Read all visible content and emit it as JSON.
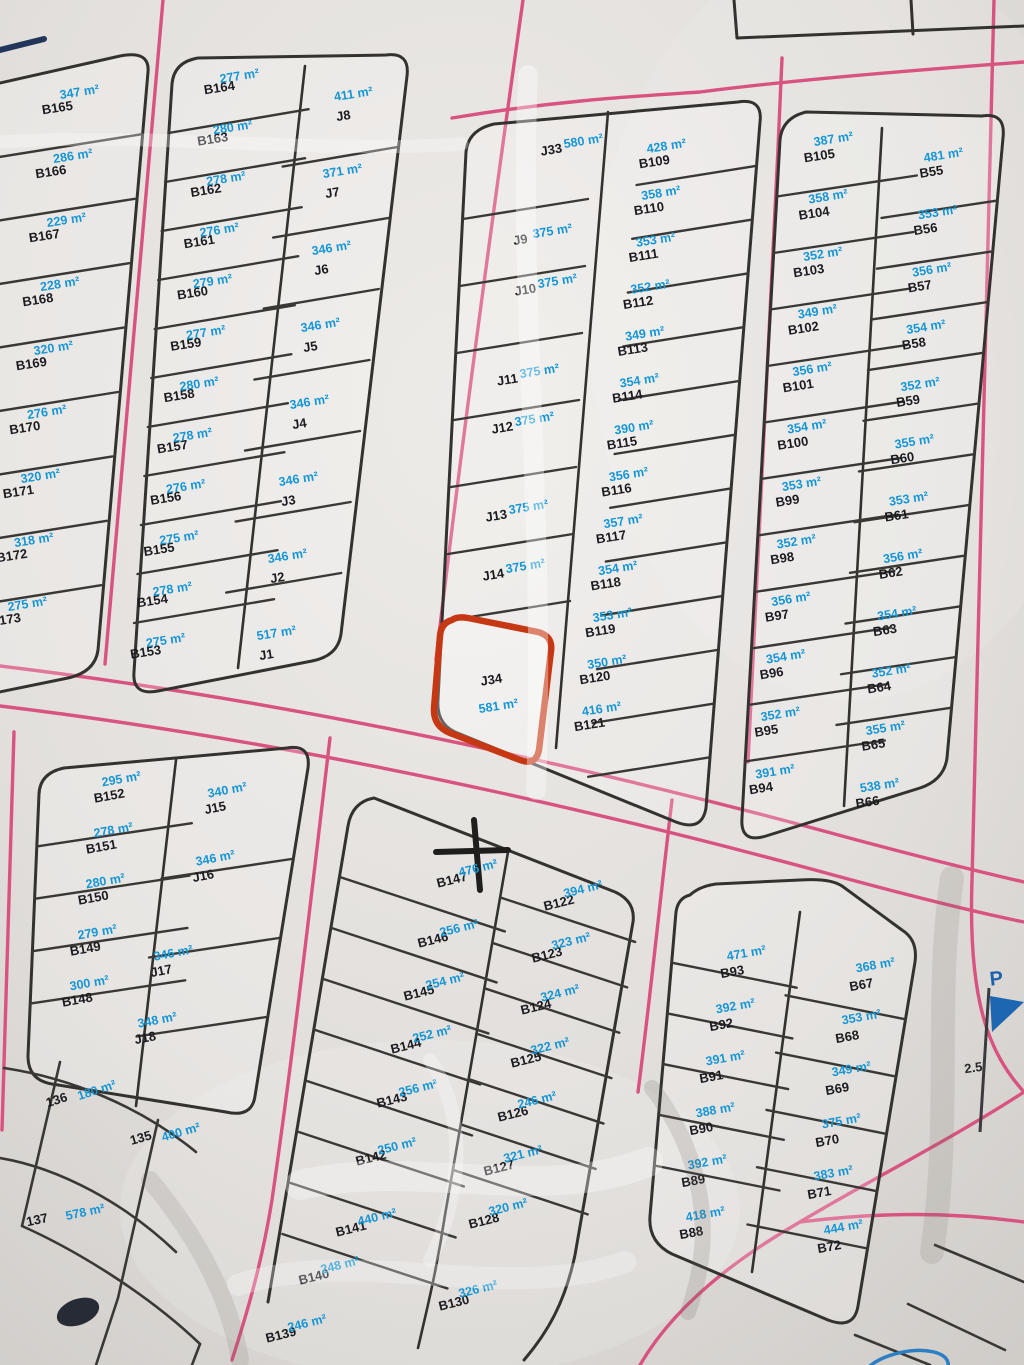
{
  "palette": {
    "road": "#d8537f",
    "parcel_line": "#34322e",
    "id_text": "#1b1b20",
    "area_text": "#1596d4",
    "highlight": "#c63813",
    "paper": "#e2dfdc"
  },
  "blocks": {
    "nw": {
      "rows": [
        {
          "id": "B165",
          "area": "347 m²"
        },
        {
          "id": "B166",
          "area": "286 m²"
        },
        {
          "id": "B167",
          "area": "229 m²"
        },
        {
          "id": "B168",
          "area": "228 m²"
        },
        {
          "id": "B169",
          "area": "320 m²"
        },
        {
          "id": "B170",
          "area": "276 m²"
        },
        {
          "id": "B171",
          "area": "320 m²"
        },
        {
          "id": "B172",
          "area": "318 m²"
        },
        {
          "id": "B173",
          "area": "275 m²"
        }
      ]
    },
    "west": {
      "left": [
        {
          "id": "B164",
          "area": "277 m²"
        },
        {
          "id": "B163",
          "area": "280 m²"
        },
        {
          "id": "B162",
          "area": "278 m²"
        },
        {
          "id": "B161",
          "area": "276 m²"
        },
        {
          "id": "B160",
          "area": "279 m²"
        },
        {
          "id": "B159",
          "area": "277 m²"
        },
        {
          "id": "B158",
          "area": "280 m²"
        },
        {
          "id": "B157",
          "area": "278 m²"
        },
        {
          "id": "B156",
          "area": "276 m²"
        },
        {
          "id": "B155",
          "area": "275 m²"
        },
        {
          "id": "B154",
          "area": "278 m²"
        },
        {
          "id": "B153",
          "area": "275 m²"
        }
      ],
      "right": [
        {
          "id": "J8",
          "area": "411 m²"
        },
        {
          "id": "J7",
          "area": "371 m²"
        },
        {
          "id": "J6",
          "area": "346 m²"
        },
        {
          "id": "J5",
          "area": "346 m²"
        },
        {
          "id": "J4",
          "area": "346 m²"
        },
        {
          "id": "J3",
          "area": "346 m²"
        },
        {
          "id": "J2",
          "area": "346 m²"
        },
        {
          "id": "J1",
          "area": "517 m²"
        }
      ]
    },
    "central": {
      "left": [
        {
          "id": "J33",
          "area": "580 m²"
        },
        {
          "id": "J9",
          "area": "375 m²"
        },
        {
          "id": "J10",
          "area": "375 m²"
        },
        {
          "id": "J11",
          "area": "375 m²"
        },
        {
          "id": "J12",
          "area": "375 m²"
        },
        {
          "id": "J13",
          "area": "375 m²"
        },
        {
          "id": "J14",
          "area": "375 m²"
        }
      ],
      "right": [
        {
          "id": "B109",
          "area": "428 m²"
        },
        {
          "id": "B110",
          "area": "358 m²"
        },
        {
          "id": "B111",
          "area": "353 m²"
        },
        {
          "id": "B112",
          "area": "352 m²"
        },
        {
          "id": "B113",
          "area": "349 m²"
        },
        {
          "id": "B114",
          "area": "354 m²"
        },
        {
          "id": "B115",
          "area": "390 m²"
        },
        {
          "id": "B116",
          "area": "356 m²"
        },
        {
          "id": "B117",
          "area": "357 m²"
        },
        {
          "id": "B118",
          "area": "354 m²"
        },
        {
          "id": "B119",
          "area": "353 m²"
        },
        {
          "id": "B120",
          "area": "350 m²"
        },
        {
          "id": "B121",
          "area": "416 m²"
        }
      ],
      "highlight": {
        "id": "J34",
        "area": "581 m²"
      }
    },
    "east": {
      "left": [
        {
          "id": "B105",
          "area": "387 m²"
        },
        {
          "id": "B104",
          "area": "358 m²"
        },
        {
          "id": "B103",
          "area": "352 m²"
        },
        {
          "id": "B102",
          "area": "349 m²"
        },
        {
          "id": "B101",
          "area": "356 m²"
        },
        {
          "id": "B100",
          "area": "354 m²"
        },
        {
          "id": "B99",
          "area": "353 m²"
        },
        {
          "id": "B98",
          "area": "352 m²"
        },
        {
          "id": "B97",
          "area": "356 m²"
        },
        {
          "id": "B96",
          "area": "354 m²"
        },
        {
          "id": "B95",
          "area": "352 m²"
        },
        {
          "id": "B94",
          "area": "391 m²"
        }
      ],
      "right": [
        {
          "id": "B55",
          "area": "481 m²"
        },
        {
          "id": "B56",
          "area": "353 m²"
        },
        {
          "id": "B57",
          "area": "356 m²"
        },
        {
          "id": "B58",
          "area": "354 m²"
        },
        {
          "id": "B59",
          "area": "352 m²"
        },
        {
          "id": "B60",
          "area": "355 m²"
        },
        {
          "id": "B61",
          "area": "353 m²"
        },
        {
          "id": "B62",
          "area": "356 m²"
        },
        {
          "id": "B63",
          "area": "354 m²"
        },
        {
          "id": "B64",
          "area": "352 m²"
        },
        {
          "id": "B65",
          "area": "355 m²"
        },
        {
          "id": "B66",
          "area": "538 m²"
        }
      ]
    },
    "sw": {
      "left": [
        {
          "id": "B152",
          "area": "295 m²"
        },
        {
          "id": "B151",
          "area": "278 m²"
        },
        {
          "id": "B150",
          "area": "280 m²"
        },
        {
          "id": "B149",
          "area": "279 m²"
        },
        {
          "id": "B148",
          "area": "300 m²"
        }
      ],
      "right": [
        {
          "id": "J15",
          "area": "340 m²"
        },
        {
          "id": "J16",
          "area": "346 m²"
        },
        {
          "id": "J17",
          "area": "346 m²"
        },
        {
          "id": "J18",
          "area": "348 m²"
        }
      ]
    },
    "south": {
      "left": [
        {
          "id": "B147",
          "area": "476 m²"
        },
        {
          "id": "B146",
          "area": "256 m²"
        },
        {
          "id": "B145",
          "area": "254 m²"
        },
        {
          "id": "B144",
          "area": "252 m²"
        },
        {
          "id": "B143",
          "area": "256 m²"
        },
        {
          "id": "B142",
          "area": "250 m²"
        },
        {
          "id": "B141",
          "area": "440 m²"
        },
        {
          "id": "B140",
          "area": "248 m²"
        },
        {
          "id": "B139",
          "area": "246 m²"
        }
      ],
      "right": [
        {
          "id": "B122",
          "area": "394 m²"
        },
        {
          "id": "B123",
          "area": "323 m²"
        },
        {
          "id": "B124",
          "area": "324 m²"
        },
        {
          "id": "B125",
          "area": "322 m²"
        },
        {
          "id": "B126",
          "area": "246 m²"
        },
        {
          "id": "B127",
          "area": "321 m²"
        },
        {
          "id": "B128",
          "area": "320 m²"
        },
        {
          "id": "B130",
          "area": "326 m²"
        }
      ]
    },
    "se": {
      "left": [
        {
          "id": "B93",
          "area": "471 m²"
        },
        {
          "id": "B92",
          "area": "392 m²"
        },
        {
          "id": "B91",
          "area": "391 m²"
        },
        {
          "id": "B90",
          "area": "388 m²"
        },
        {
          "id": "B89",
          "area": "392 m²"
        },
        {
          "id": "B88",
          "area": "418 m²"
        }
      ],
      "right": [
        {
          "id": "B67",
          "area": "368 m²"
        },
        {
          "id": "B68",
          "area": "353 m²"
        },
        {
          "id": "B69",
          "area": "349 m²"
        },
        {
          "id": "B70",
          "area": "375 m²"
        },
        {
          "id": "B71",
          "area": "383 m²"
        },
        {
          "id": "B72",
          "area": "444 m²"
        }
      ]
    }
  },
  "fragments": {
    "items": [
      {
        "id": "136",
        "area": "180 m²"
      },
      {
        "id": "135",
        "area": "400 m²"
      },
      {
        "id": "137",
        "area": "578 m²"
      }
    ]
  },
  "margin": {
    "flag_letter": "P",
    "measure": "2.5"
  }
}
